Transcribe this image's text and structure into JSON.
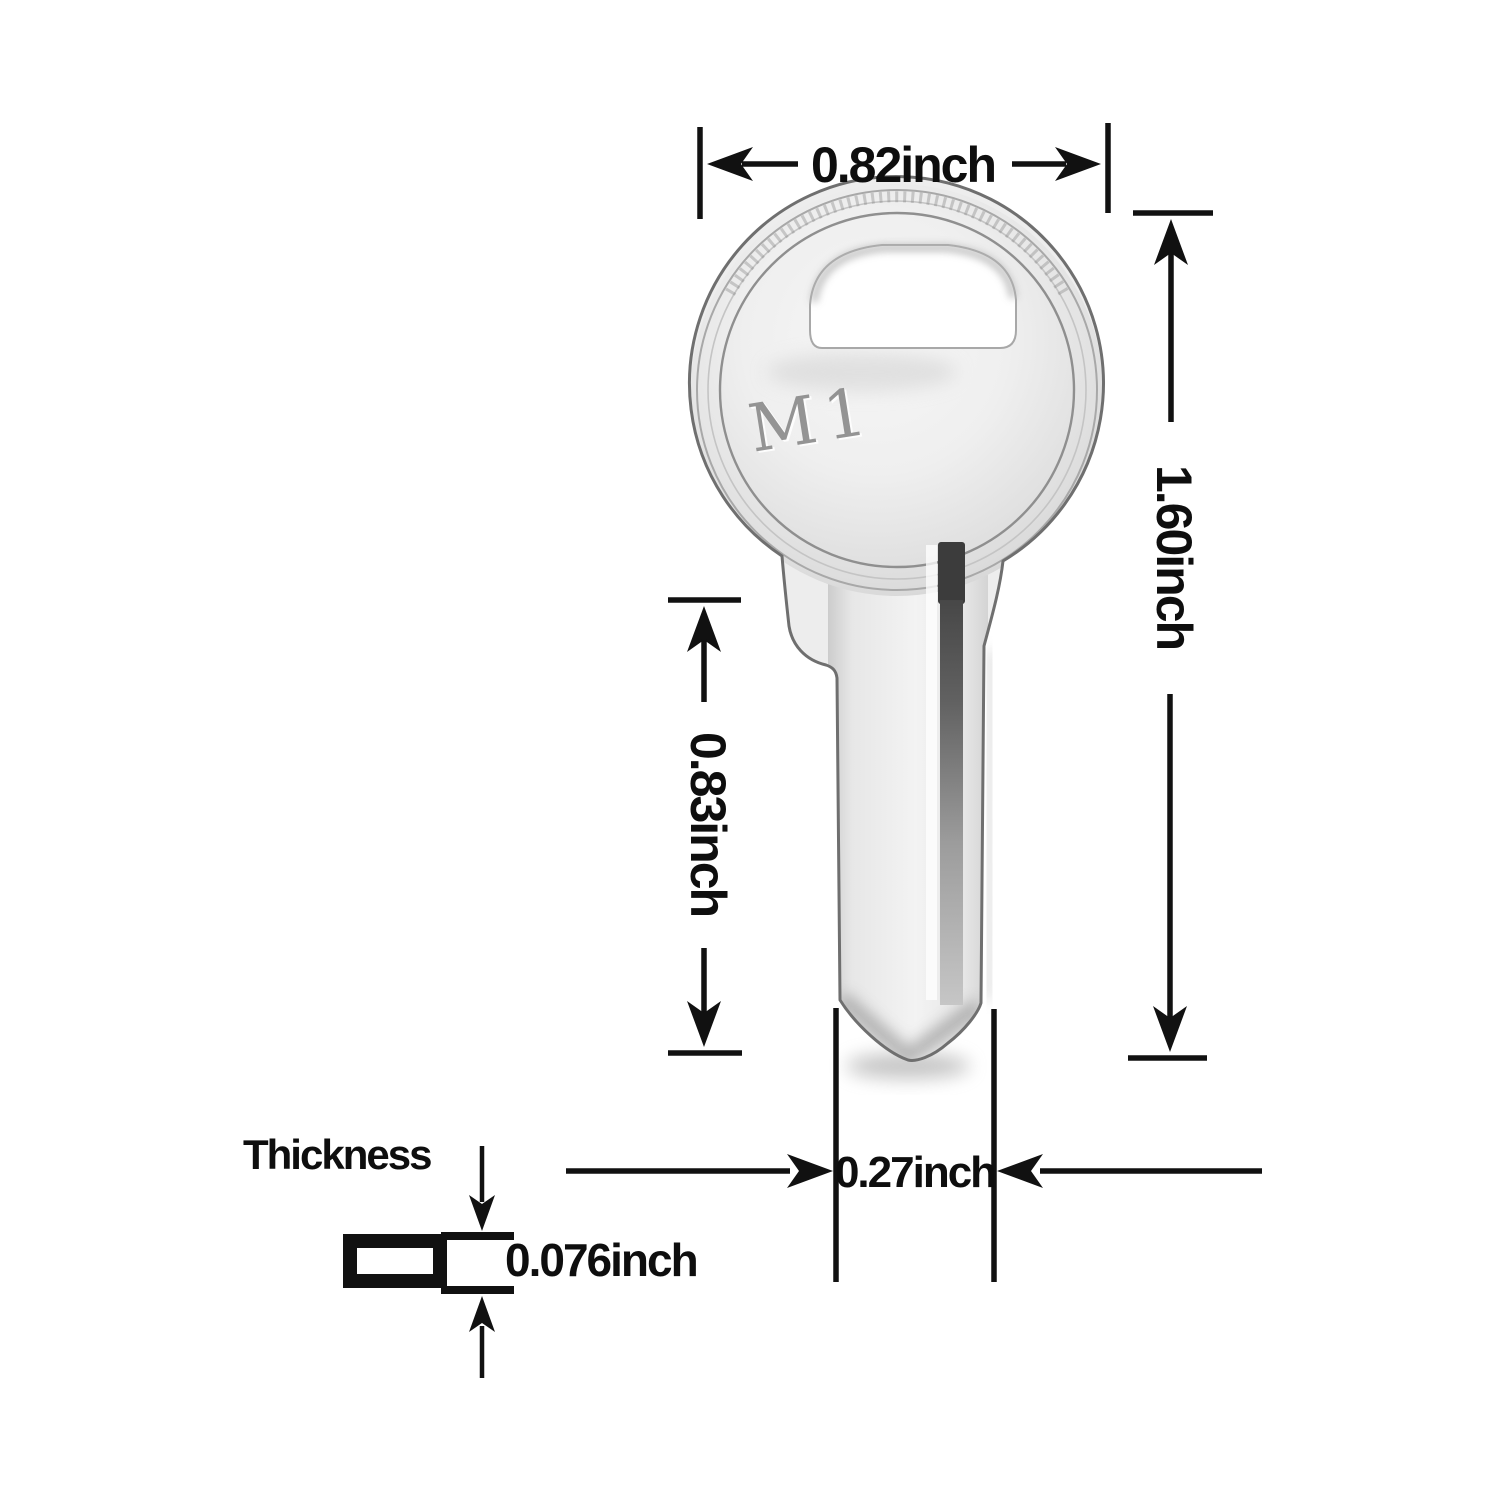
{
  "figure": {
    "type": "product-dimension-diagram",
    "subject": "key blank",
    "background": "#ffffff",
    "key": {
      "marking": "M1",
      "metal_light": "#f4f4f4",
      "metal_mid": "#e6e6e6",
      "metal_dark": "#cfcfcf",
      "outline": "#6f6f6f",
      "groove_dark": "#3c3c3c"
    },
    "dimensions": {
      "head_width": {
        "label": "0.82inch"
      },
      "total_height": {
        "label": "1.60inch"
      },
      "blade_length": {
        "label": "0.83inch"
      },
      "blade_width": {
        "label": "0.27inch"
      },
      "thickness": {
        "label": "Thickness",
        "value": "0.076inch"
      }
    },
    "ink_color": "#111111"
  }
}
